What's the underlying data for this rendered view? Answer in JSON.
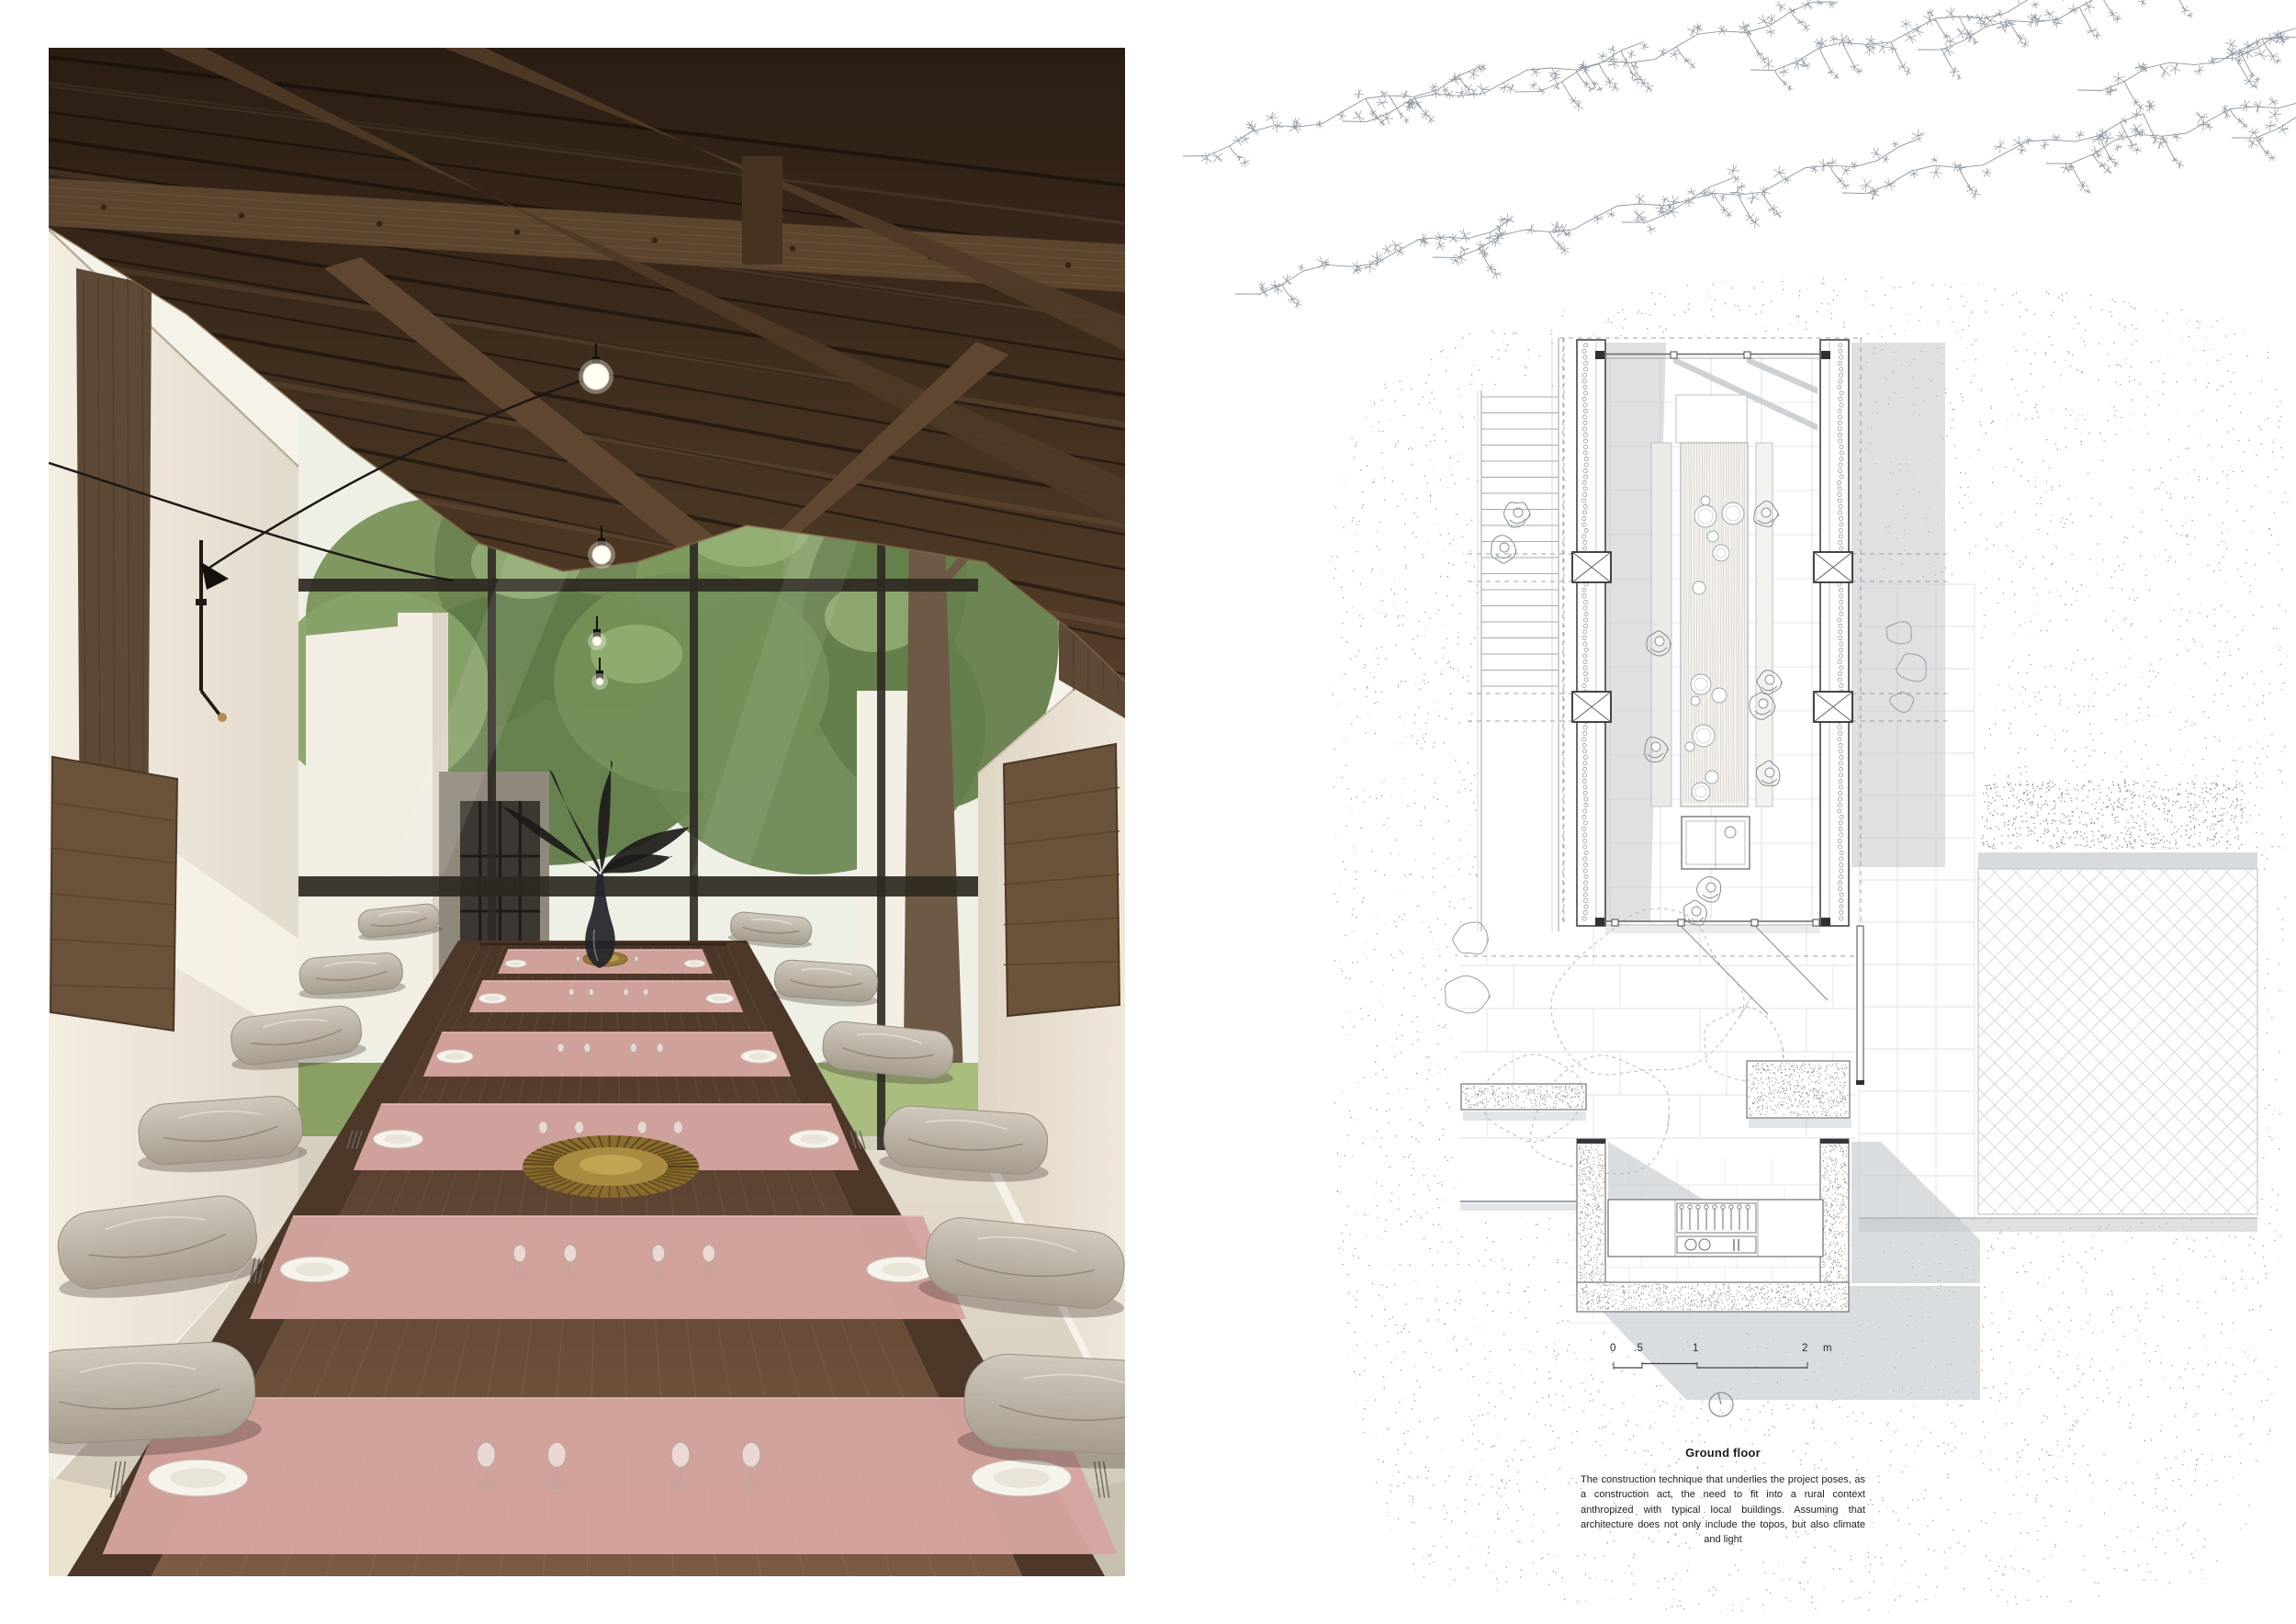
{
  "plan": {
    "title": "Ground floor",
    "caption": "The construction technique that underlies the project poses, as a construction act, the need to fit into a rural context anthropized with typical local buildings. Assuming that architecture does not only include the topos, but also climate and light",
    "scale_bar": {
      "labels": [
        "0",
        ".5",
        "1",
        "2",
        "m"
      ]
    }
  },
  "colors": {
    "paper": "#ffffff",
    "plan_line": "#43474b",
    "plan_line_light": "#9aa0a5",
    "plan_tile": "#d4d8db",
    "plan_stipple": "#6f757b",
    "plan_shadow": "#c2c7cb",
    "branch": "#8d97a0",
    "roof_dark": "#2a1d12",
    "roof_light": "#543d29",
    "beam": "#5c452f",
    "wall_cream": "#efe8db",
    "floor_concrete": "#d9d2c3",
    "table_far": "#4a3527",
    "table_near": "#7b5b43",
    "runner_pink": "#d5a4a0",
    "cushion": "#bfb5a7",
    "foliage": "#6f8955",
    "brass": "#967939",
    "plant_dark": "#1c1b19"
  }
}
